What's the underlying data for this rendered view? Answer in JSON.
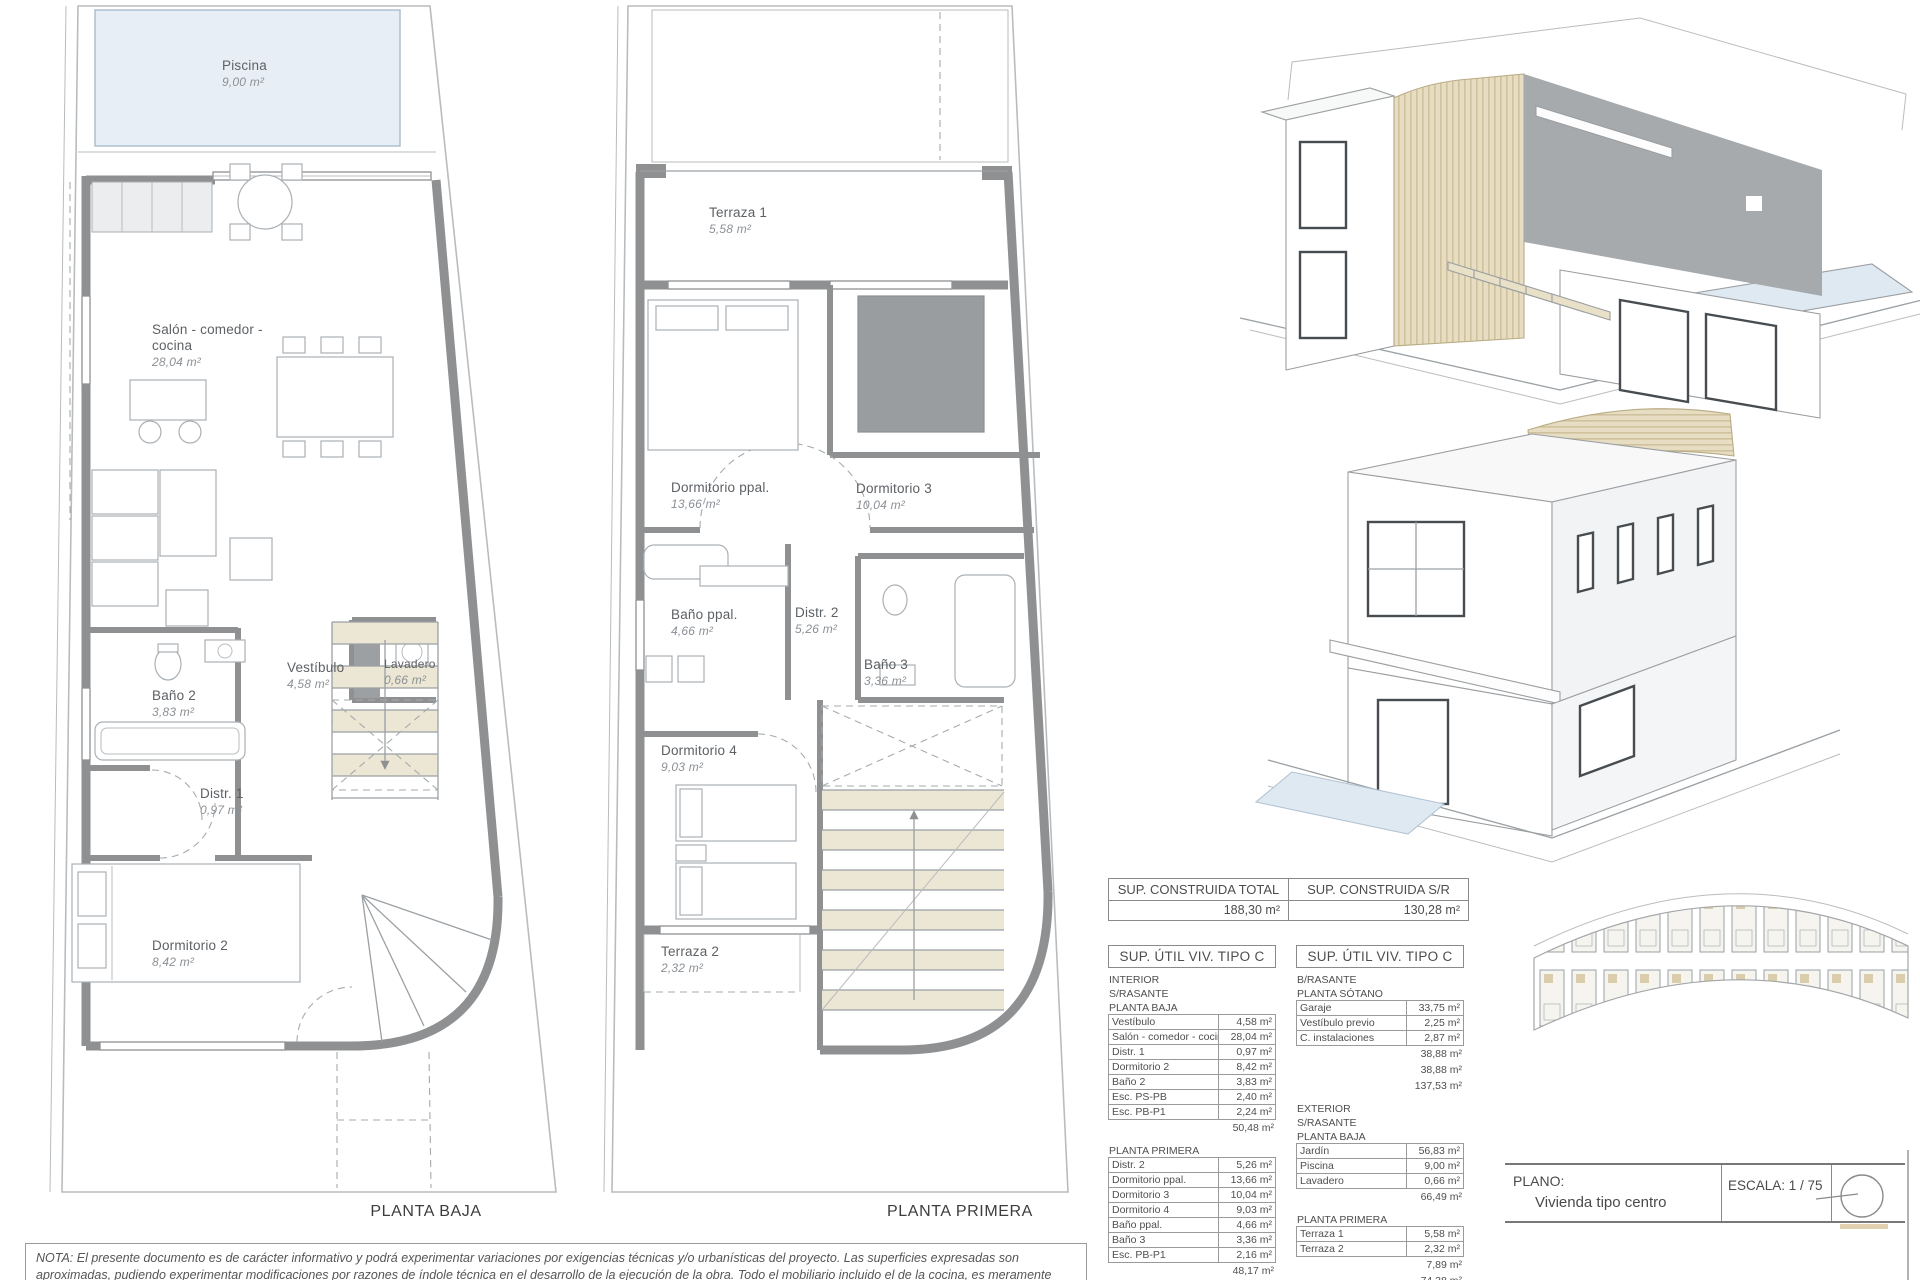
{
  "plans": {
    "baja": {
      "title": "PLANTA BAJA",
      "rooms": [
        {
          "name": "Piscina",
          "area": "9,00 m²"
        },
        {
          "name": "Salón - comedor - cocina",
          "area": "28,04 m²"
        },
        {
          "name": "Vestíbulo",
          "area": "4,58 m²"
        },
        {
          "name": "Lavadero",
          "area": "0,66 m²"
        },
        {
          "name": "Baño 2",
          "area": "3,83 m²"
        },
        {
          "name": "Distr. 1",
          "area": "0,97 m²"
        },
        {
          "name": "Dormitorio 2",
          "area": "8,42 m²"
        }
      ]
    },
    "primera": {
      "title": "PLANTA PRIMERA",
      "rooms": [
        {
          "name": "Terraza 1",
          "area": "5,58 m²"
        },
        {
          "name": "Dormitorio ppal.",
          "area": "13,66 m²"
        },
        {
          "name": "Dormitorio 3",
          "area": "10,04 m²"
        },
        {
          "name": "Baño ppal.",
          "area": "4,66 m²"
        },
        {
          "name": "Distr. 2",
          "area": "5,26 m²"
        },
        {
          "name": "Baño 3",
          "area": "3,36 m²"
        },
        {
          "name": "Dormitorio 4",
          "area": "9,03 m²"
        },
        {
          "name": "Terraza 2",
          "area": "2,32 m²"
        }
      ]
    }
  },
  "summary": {
    "cells": [
      {
        "header": "SUP. CONSTRUIDA TOTAL",
        "value": "188,30 m²"
      },
      {
        "header": "SUP. CONSTRUIDA S/R",
        "value": "130,28 m²"
      }
    ]
  },
  "table_left": {
    "title": "SUP. ÚTIL VIV. TIPO C",
    "entries": [
      {
        "t": "label",
        "text": "INTERIOR"
      },
      {
        "t": "label",
        "text": "S/RASANTE"
      },
      {
        "t": "label",
        "text": "PLANTA BAJA"
      },
      {
        "t": "row",
        "label": "Vestíbulo",
        "value": "4,58 m²"
      },
      {
        "t": "row",
        "label": "Salón - comedor - cocina",
        "value": "28,04 m²"
      },
      {
        "t": "row",
        "label": "Distr. 1",
        "value": "0,97 m²"
      },
      {
        "t": "row",
        "label": "Dormitorio 2",
        "value": "8,42 m²"
      },
      {
        "t": "row",
        "label": "Baño 2",
        "value": "3,83 m²"
      },
      {
        "t": "row",
        "label": "Esc. PS-PB",
        "value": "2,40 m²"
      },
      {
        "t": "row",
        "label": "Esc. PB-P1",
        "value": "2,24 m²"
      },
      {
        "t": "sum",
        "value": "50,48 m²"
      },
      {
        "t": "gap"
      },
      {
        "t": "label",
        "text": "PLANTA PRIMERA"
      },
      {
        "t": "row",
        "label": "Distr. 2",
        "value": "5,26 m²"
      },
      {
        "t": "row",
        "label": "Dormitorio ppal.",
        "value": "13,66 m²"
      },
      {
        "t": "row",
        "label": "Dormitorio 3",
        "value": "10,04 m²"
      },
      {
        "t": "row",
        "label": "Dormitorio 4",
        "value": "9,03 m²"
      },
      {
        "t": "row",
        "label": "Baño ppal.",
        "value": "4,66 m²"
      },
      {
        "t": "row",
        "label": "Baño 3",
        "value": "3,36 m²"
      },
      {
        "t": "row",
        "label": "Esc. PB-P1",
        "value": "2,16 m²"
      },
      {
        "t": "sum",
        "value": "48,17 m²"
      },
      {
        "t": "sum",
        "value": "98,65 m²"
      }
    ]
  },
  "table_right": {
    "title": "SUP. ÚTIL VIV. TIPO C",
    "entries": [
      {
        "t": "label",
        "text": "B/RASANTE"
      },
      {
        "t": "label",
        "text": "PLANTA SÓTANO"
      },
      {
        "t": "row",
        "label": "Garaje",
        "value": "33,75 m²"
      },
      {
        "t": "row",
        "label": "Vestíbulo previo",
        "value": "2,25 m²"
      },
      {
        "t": "row",
        "label": "C. instalaciones",
        "value": "2,87 m²"
      },
      {
        "t": "sum",
        "value": "38,88 m²"
      },
      {
        "t": "sum",
        "value": "38,88 m²"
      },
      {
        "t": "sum",
        "value": "137,53 m²"
      },
      {
        "t": "gap"
      },
      {
        "t": "label",
        "text": "EXTERIOR"
      },
      {
        "t": "label",
        "text": "S/RASANTE"
      },
      {
        "t": "label",
        "text": "PLANTA BAJA"
      },
      {
        "t": "row",
        "label": "Jardín",
        "value": "56,83 m²"
      },
      {
        "t": "row",
        "label": "Piscina",
        "value": "9,00 m²"
      },
      {
        "t": "row",
        "label": "Lavadero",
        "value": "0,66 m²"
      },
      {
        "t": "sum",
        "value": "66,49 m²"
      },
      {
        "t": "gap"
      },
      {
        "t": "label",
        "text": "PLANTA PRIMERA"
      },
      {
        "t": "row",
        "label": "Terraza 1",
        "value": "5,58 m²"
      },
      {
        "t": "row",
        "label": "Terraza 2",
        "value": "2,32 m²"
      },
      {
        "t": "sum",
        "value": "7,89 m²"
      },
      {
        "t": "sum",
        "value": "74,38 m²"
      },
      {
        "t": "sum",
        "value": "74,38 m²"
      }
    ]
  },
  "title_block": {
    "plano_label": "PLANO:",
    "plano_value": "Vivienda tipo centro",
    "escala": "ESCALA:  1 / 75",
    "north_label": "N"
  },
  "note": "NOTA: El presente documento es de carácter informativo y podrá experimentar variaciones por exigencias técnicas y/o urbanísticas del proyecto. Las superficies expresadas son aproximadas, pudiendo experimentar modificaciones por razones de índole técnica en el desarrollo de la ejecución de la obra. Todo el mobiliario incluido el de la cocina, es meramente informativo. No va instalada. Los giros de las puertas y la distribución de aparatos sanitarios no son vinculantes.",
  "colors": {
    "wall": "#8e9092",
    "pool": "#e7eef5",
    "wood": "#e6ddc2",
    "dark_panel": "#a6aaad",
    "stair_tread": "#ece6d4"
  }
}
